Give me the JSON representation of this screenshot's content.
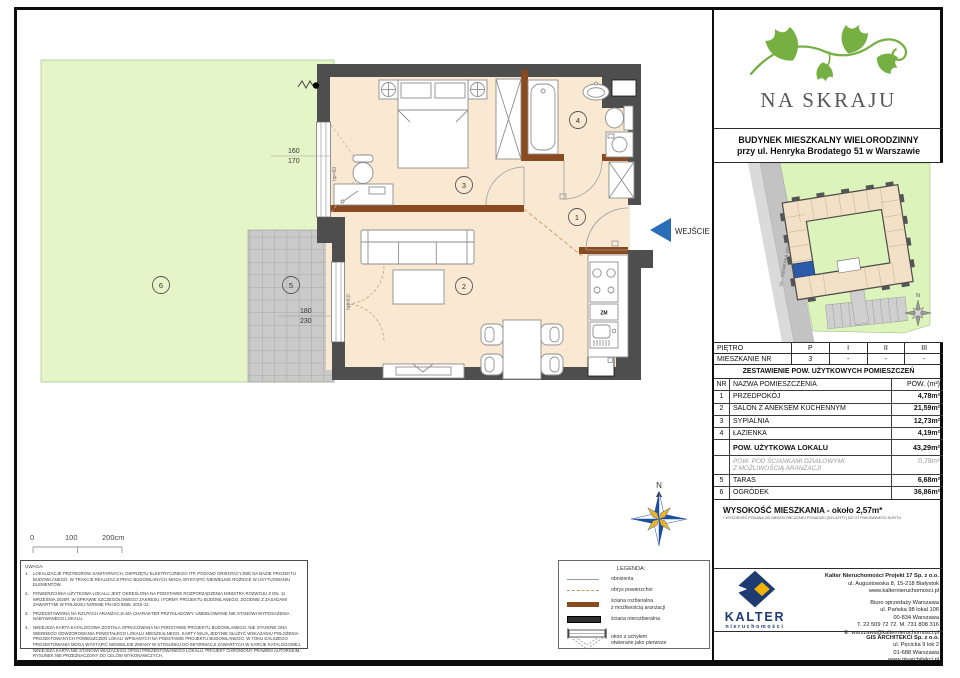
{
  "plan": {
    "numbers": [
      "1",
      "2",
      "3",
      "4",
      "5",
      "6"
    ],
    "wejscie": "WEJŚCIE",
    "window_dim_top": "160",
    "window_dim_bottom": "170",
    "window_hp": "hp=60",
    "door_dim_top": "180",
    "door_dim_bottom": "230",
    "door_hp": "hp=0,0",
    "kitchen_zm": "ZM",
    "scale": {
      "t0": "0",
      "t1": "100",
      "t2": "200cm"
    },
    "compass_n": "N"
  },
  "brand": {
    "name": "NA SKRAJU",
    "title_line1": "BUDYNEK MIESZKALNY WIELORODZINNY",
    "title_line2": "przy ul. Henryka Brodatego 51 w Warszawie"
  },
  "siteplan": {
    "street": "UL. HENRYKA BRODATEGO",
    "north": "N"
  },
  "floor_row": {
    "label": "PIĘTRO",
    "values": [
      "P",
      "I",
      "II",
      "III"
    ]
  },
  "unit_row": {
    "label": "MIESZKANIE NR",
    "values": [
      "3",
      "-",
      "-",
      "-"
    ]
  },
  "area_table": {
    "title": "ZESTAWIENIE POW. UŻYTKOWYCH POMIESZCZEŃ",
    "col_nr": "NR",
    "col_name": "NAZWA POMIESZCZENIA",
    "col_area": "POW. (m²)",
    "rows": [
      {
        "nr": "1",
        "name": "PRZEDPOKÓJ",
        "area": "4,78m²"
      },
      {
        "nr": "2",
        "name": "SALON Z ANEKSEM KUCHENNYM",
        "area": "21,59m²"
      },
      {
        "nr": "3",
        "name": "SYPIALNIA",
        "area": "12,73m²"
      },
      {
        "nr": "4",
        "name": "ŁAZIENKA",
        "area": "4,19m²"
      }
    ],
    "total_label": "POW. UŻYTKOWA LOKALU",
    "total_area": "43,29m²",
    "partition_line1": "POW. POD ŚCIANKAMI DZIAŁOWYMI",
    "partition_line2": "Z MOŻLIWOŚCIĄ ARANŻACJI",
    "partition_area": "0,78m²",
    "outdoor_rows": [
      {
        "nr": "5",
        "name": "TARAS",
        "area": "6,68m²"
      },
      {
        "nr": "6",
        "name": "OGRÓDEK",
        "area": "36,86m²"
      }
    ],
    "height_label": "WYSOKOŚĆ MIESZKANIA - około 2,57m*",
    "height_note": "* WYSOKOŚĆ PODANA OD NIEWYKOŃCZONEJ POSADZKI (SZLICHTY) DO OTYNKOWANEGO SUFITU"
  },
  "legend": {
    "title": "LEGENDA:",
    "item1": "obniżenia",
    "item2": "obrys powierzchni",
    "item3a": "ściana rozbieralna",
    "item3b": "z możliwością aranżacji",
    "item4": "ściana nierozbieralna",
    "item5a": "okno z uchyłem",
    "item5b": "otwierane jako pierwsze"
  },
  "notes": {
    "title": "UWAGA:",
    "n1_num": "1.",
    "n1": "LOKALIZACJE PRZYBORÓW SANITARNYCH, OSPRZĘTU ELEKTRYCZNEGO ITP. PODANO ORIENTACYJNIE NA BAZIE PROJEKTU BUDOWLANEGO. W TRAKCIE REALIZACJI PRAC BUDOWLANYCH MOGĄ WYSTĄPIĆ NIEWIELKIE RÓŻNICE W USYTUOWANIU ELEMENTÓW.",
    "n2_num": "2.",
    "n2": "POWIERZCHNIA UŻYTKOWA LOKALU JEST OKREŚLONA NA PODSTAWIE ROZPORZĄDZENIA MINISTRA ROZWOJU Z DN. 11 WRZEŚNIA 2020R. W SPRAWIE SZCZEGÓŁOWEGO ZAKRESU I FORMY PROJEKTU BUDOWLANEGO, ZGODNIE Z ZASADAMI ZAWARTYMI W POLSKIEJ NORMIE PN-ISO 9836: 2015-12.",
    "n3_num": "3.",
    "n3": "PRZEDSTAWIONA NA RZUTACH ARANŻACJA MA CHARAKTER PRZYKŁADOWY. UMEBLOWANIE NIE STANOWI WYPOSAŻENIA NABYWANEGO LOKALU.",
    "n4_num": "4.",
    "n4": "NINIEJSZA KARTA KATALOGOWA ZOSTAŁA OPRACOWANA NA PODSTAWIE PROJEKTU BUDOWLANEGO. NIE STANOWI ONA WIERNEGO ODWZOROWANIA POWSTAŁEGO LOKALU MIESZKALNEGO. KARTY MAJĄ JEDYNIE SŁUŻYĆ WSKAZANIU POŁOŻENIA PROJEKTOWANYCH POMIESZCZEŃ LOKALI WPISANYCH NA PODSTAWIE PROJEKTU BUDOWLANEGO. W TOKU DALSZEGO PROJEKTOWANIA MOGĄ WYSTĄPIĆ NIEWIELKIE ZMIANY W STOSUNKU DO INFORMACJI ZAWARTYCH W KARCIE KATALOGOWEJ. NINIEJSZA KARTA NIE STANOWI WIĄŻĄCEGO OPISU PREZENTOWANEGO LOKALU. PROJEKT CHRONIONY PRAWEM AUTORSKIM. RYSUNEK NIE PRZEZNACZONY DO CELÓW WYKONAWCZYCH."
  },
  "footer": {
    "kalter_name": "KALTER",
    "kalter_sub": "nieruchomości",
    "dev1": "Kalter Nieruchomości Projekt 17 Sp. z o.o.",
    "dev2": "ul. Augustowska 8, 15-218 Białystok",
    "dev3": "www.kalternieruchomosci.pl",
    "office1": "Biuro sprzedaży Warszawa",
    "office2": "ul. Pańska 98 lokal 106",
    "office3": "00-834 Warszawa",
    "office4": "T. 22 509 72 72. M. 731 808 316",
    "office5": "E. warszawa@kalternieruchomosci.pl",
    "arch1": "GIS ARCHITEKCI Sp. z o.o.",
    "arch2": "ul. Pęcicka 9 lok 2",
    "arch3": "01-688 Warszawa",
    "arch4": "www.gisarchitekci.pl"
  },
  "colors": {
    "accent_blue": "#2a6db8",
    "wall_dark": "#4e4e4e",
    "wall_brown": "#8a4a1f",
    "garden_green": "#e4f6c8",
    "floor_peach": "#f9e8d2",
    "kalter_navy": "#1e3c72",
    "kalter_gold": "#f0b400",
    "leaf_green": "#76b043"
  }
}
